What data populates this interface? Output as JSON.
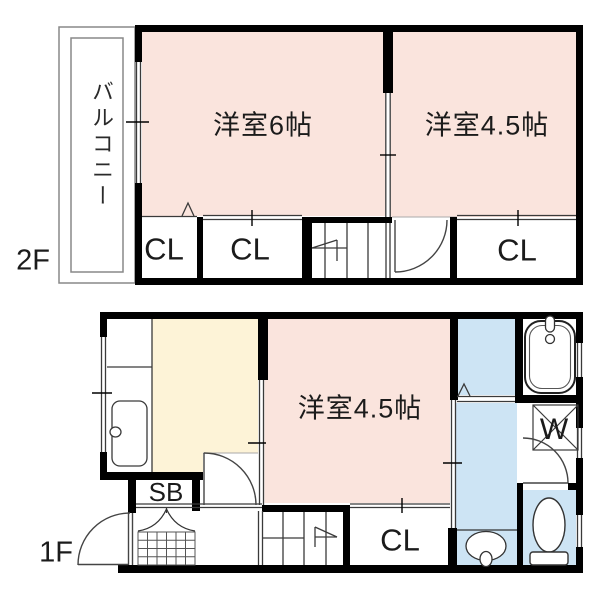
{
  "colors": {
    "room_pink": "#fae4dd",
    "kitchen_yellow": "#fdf3d7",
    "wet_area_blue": "#cde4f4",
    "wall_black": "#000000"
  },
  "floor_2f": {
    "floor_label": "2F",
    "balcony_label": "バルコニー",
    "rooms": [
      {
        "label": "洋室6帖"
      },
      {
        "label": "洋室4.5帖"
      }
    ],
    "closets": [
      {
        "label": "CL"
      },
      {
        "label": "CL"
      },
      {
        "label": "CL"
      }
    ]
  },
  "floor_1f": {
    "floor_label": "1F",
    "room_label": "洋室4.5帖",
    "shoe_box_label": "SB",
    "closet_label": "CL",
    "washer_label": "W"
  }
}
